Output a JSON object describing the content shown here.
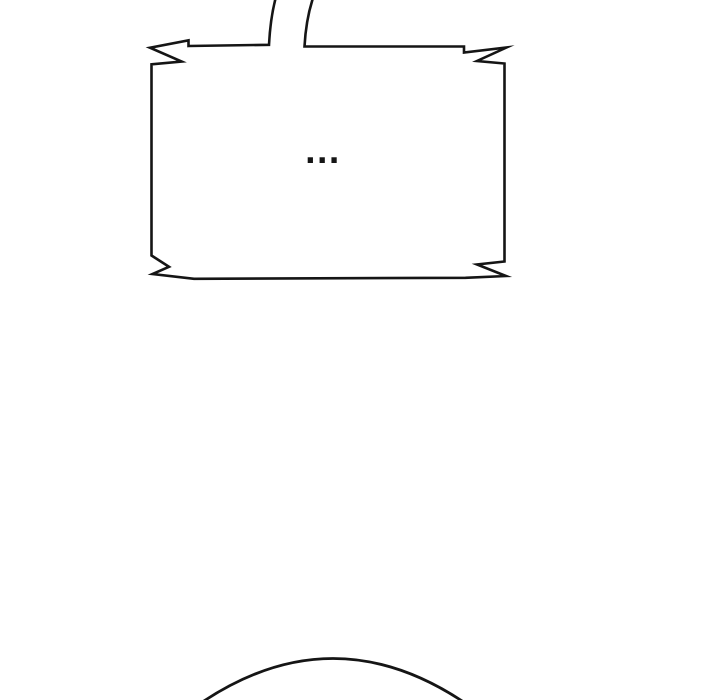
{
  "page": {
    "width": 720,
    "height": 700,
    "background_color": "#ffffff",
    "line_color": "#151515"
  },
  "speech_bubble": {
    "text": "...",
    "shape": "jagged-burst-rectangle",
    "tail_direction": "up-offscreen"
  },
  "artwork": {
    "bottom_shape": "character-head-top-arc"
  }
}
